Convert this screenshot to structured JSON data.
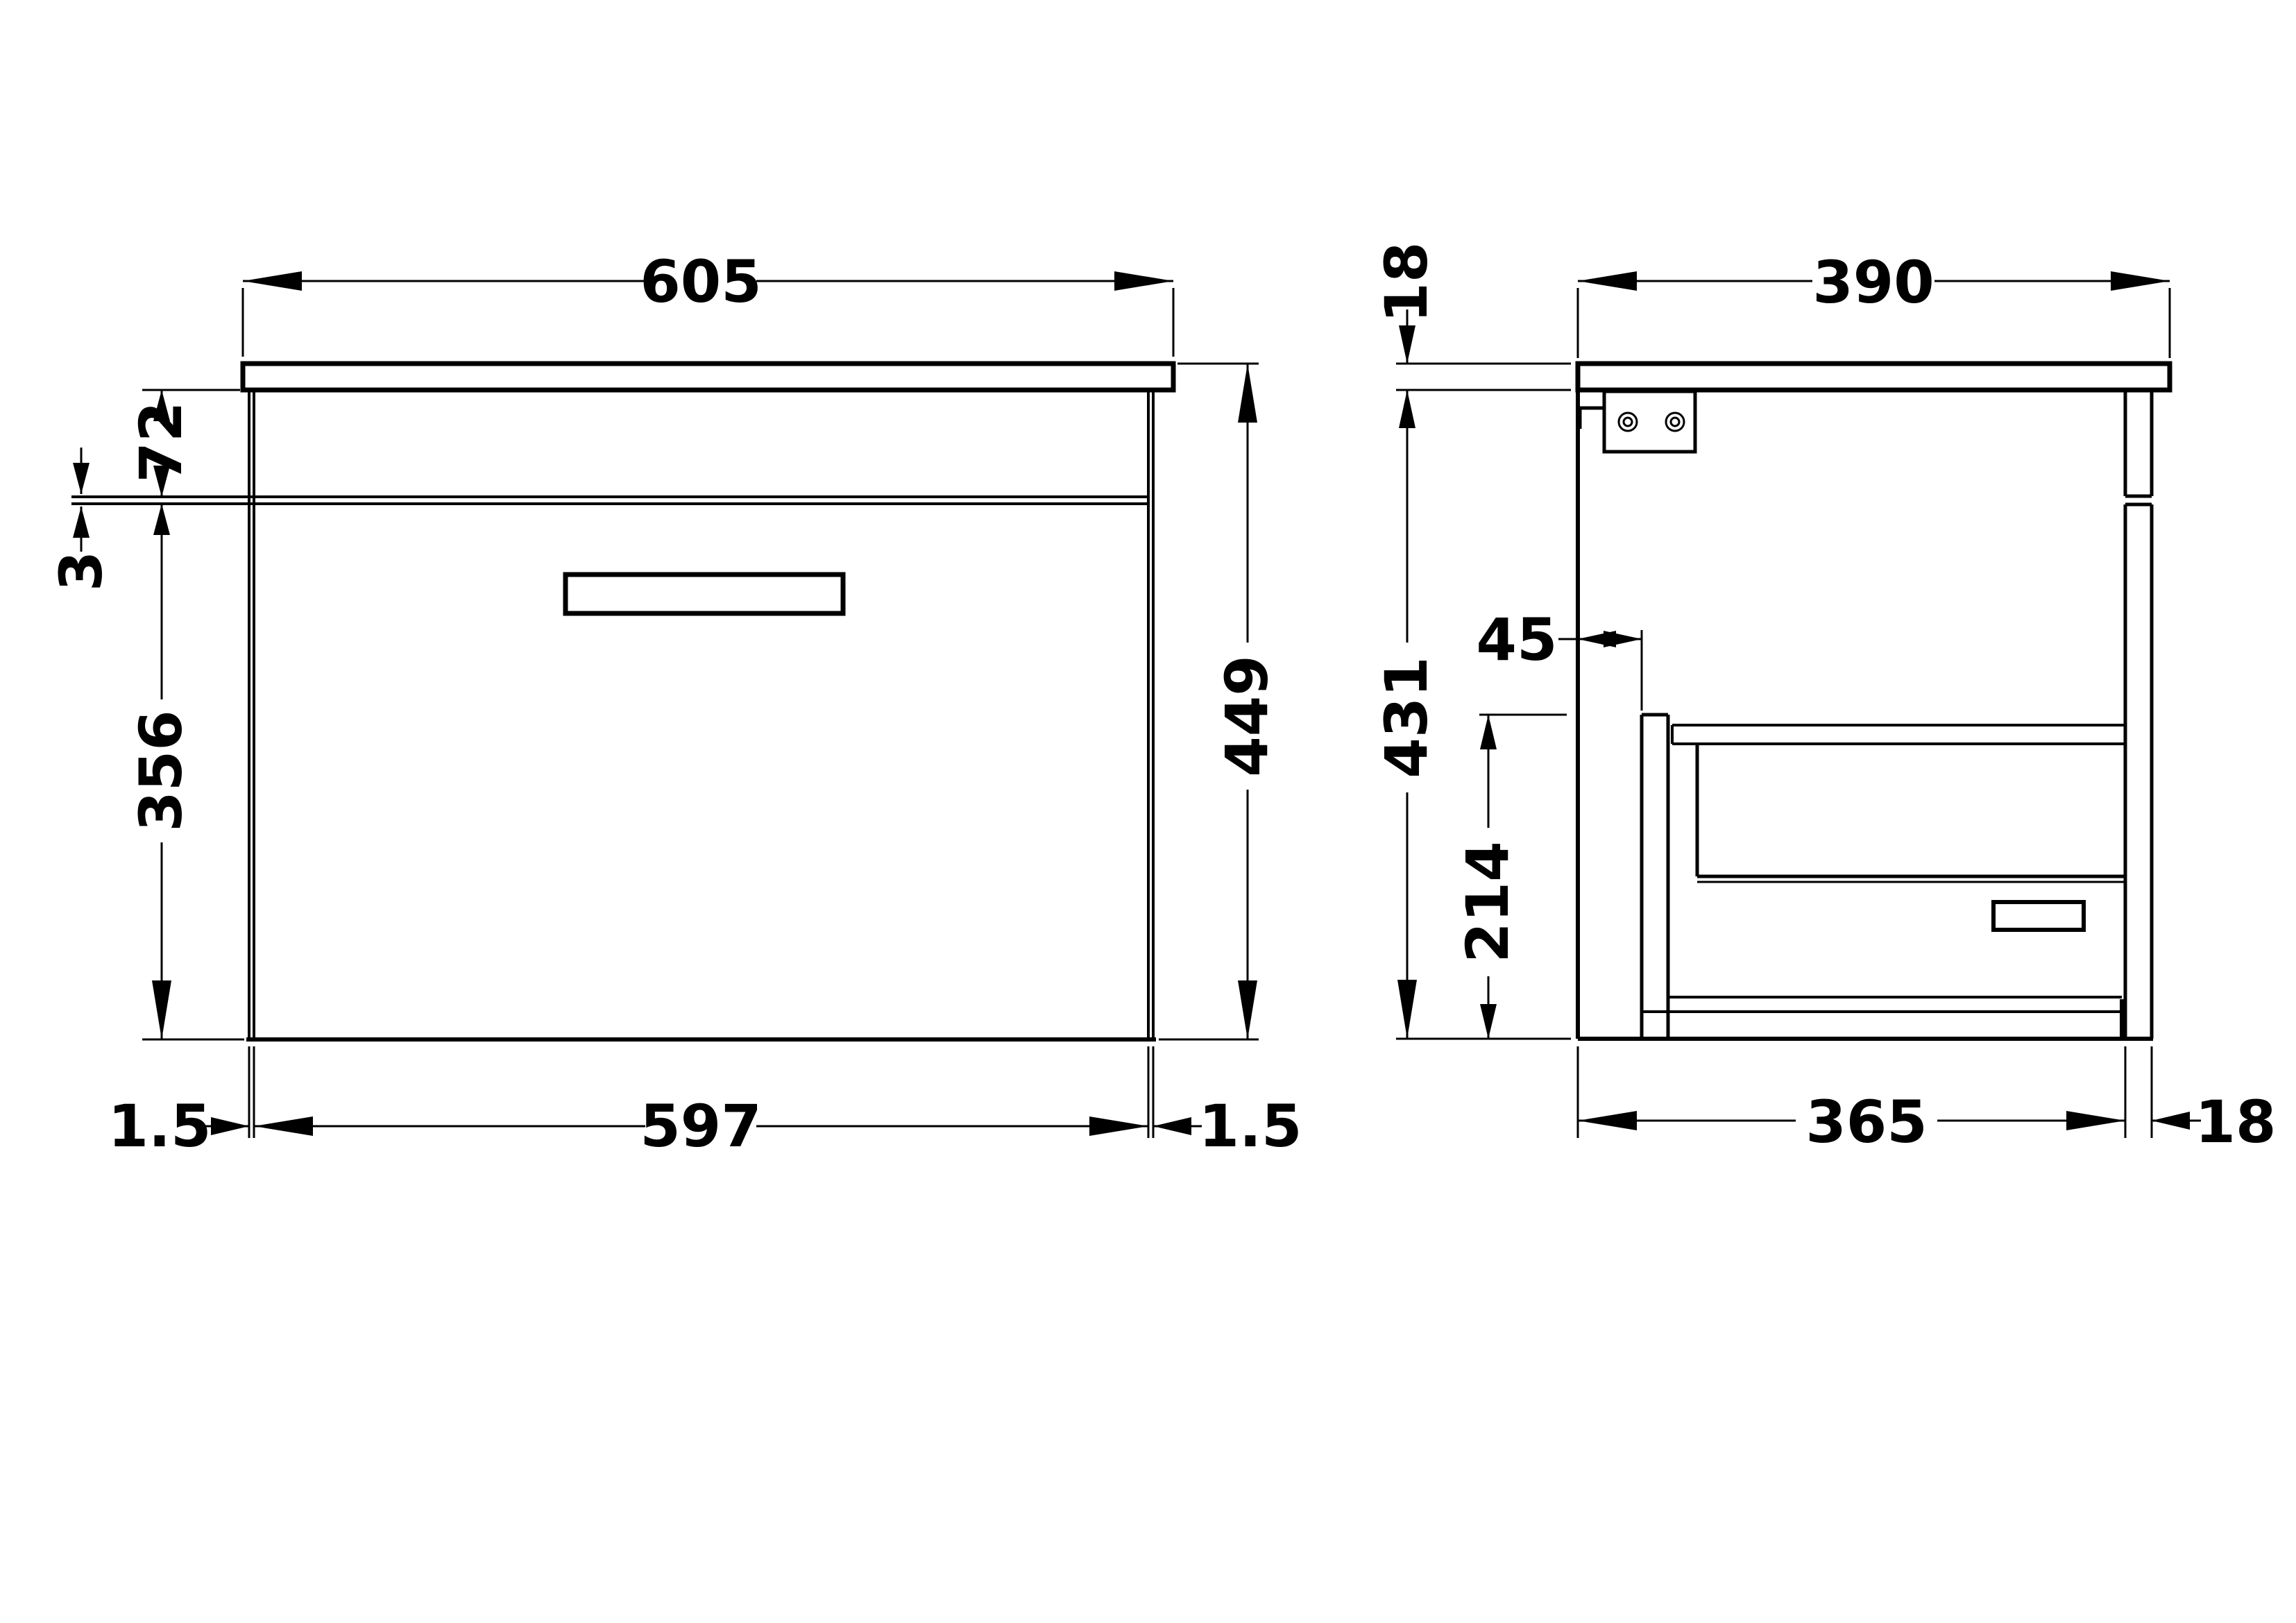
{
  "drawing": {
    "type": "vanity-unit-technical-drawing",
    "units": "mm",
    "colors": {
      "line": "#000000",
      "background": "#ffffff"
    }
  },
  "front_view": {
    "dimensions": {
      "countertop_width": "605",
      "top_section_height": "72",
      "reveal_gap": "3",
      "drawer_front_height": "356",
      "overall_height": "449",
      "drawer_front_width": "597",
      "left_reveal": "1.5",
      "right_reveal": "1.5"
    }
  },
  "side_view": {
    "dimensions": {
      "countertop_thickness": "18",
      "countertop_depth": "390",
      "cabinet_height": "431",
      "service_gap": "45",
      "drawer_box_height": "214",
      "cabinet_depth": "365",
      "front_thickness": "18"
    }
  }
}
